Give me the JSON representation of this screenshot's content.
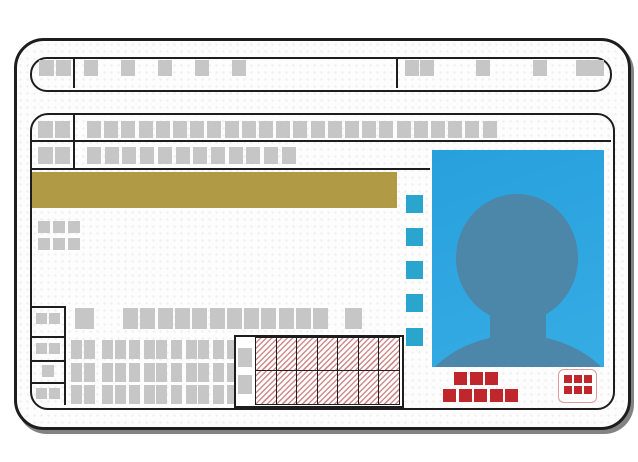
{
  "card": {
    "kind": "id-card-placeholder-illustration",
    "text_content": "none (all fields are placeholder blocks)"
  },
  "icons": {
    "photo_placeholder": "person-silhouette"
  },
  "colors": {
    "ink": "#1d1d1d",
    "placeholder_gray": "#c6c6c6",
    "gold_band": "#b09a46",
    "accent_blue": "#2aa5cd",
    "photo_background_top": "#27a0dc",
    "photo_background_bottom": "#36ace4",
    "silhouette_blue": "#4c86a8",
    "stamp_red": "#bf272c",
    "hatch_red": "#d08c8c",
    "stamp_box_border": "#e09b9b"
  },
  "blocks": {
    "header_left": [
      {
        "x": 39,
        "y": 60,
        "w": 15,
        "h": 16
      },
      {
        "x": 56,
        "y": 60,
        "w": 15,
        "h": 16
      }
    ],
    "header_mid": [
      {
        "x": 84,
        "y": 60,
        "w": 14,
        "h": 16,
        "repeat": 5,
        "pitch": 37
      }
    ],
    "header_right": [
      {
        "x": 405,
        "y": 60,
        "w": 14,
        "h": 16
      },
      {
        "x": 420,
        "y": 60,
        "w": 14,
        "h": 16
      },
      {
        "x": 476,
        "y": 60,
        "w": 14,
        "h": 16
      },
      {
        "x": 533,
        "y": 60,
        "w": 14,
        "h": 16
      },
      {
        "x": 576,
        "y": 60,
        "w": 14,
        "h": 16
      },
      {
        "x": 590,
        "y": 60,
        "w": 14,
        "h": 16
      }
    ],
    "band_row1_left": [
      {
        "x": 38,
        "y": 121,
        "w": 15,
        "h": 17
      },
      {
        "x": 55,
        "y": 121,
        "w": 15,
        "h": 17
      }
    ],
    "band_row1_run": [
      {
        "x": 87,
        "y": 121,
        "w": 14,
        "h": 17,
        "repeat": 24,
        "pitch": 17.2
      }
    ],
    "band_row2_left": [
      {
        "x": 38,
        "y": 147,
        "w": 15,
        "h": 17
      },
      {
        "x": 55,
        "y": 147,
        "w": 15,
        "h": 17
      }
    ],
    "band_row2_run": [
      {
        "x": 87,
        "y": 147,
        "w": 14,
        "h": 17,
        "repeat": 12,
        "pitch": 17.7
      }
    ],
    "mini_rows": [
      {
        "x": 38,
        "y": 221,
        "w": 12,
        "h": 12,
        "repeat": 3,
        "pitch": 15
      },
      {
        "x": 38,
        "y": 238,
        "w": 12,
        "h": 12,
        "repeat": 3,
        "pitch": 15
      }
    ],
    "number_label": [
      {
        "x": 36,
        "y": 313,
        "w": 11,
        "h": 11
      },
      {
        "x": 49,
        "y": 313,
        "w": 11,
        "h": 11
      }
    ],
    "number_big": [
      {
        "x": 75,
        "y": 308,
        "w": 19,
        "h": 21
      }
    ],
    "number_digits": [
      {
        "x": 123,
        "y": 308,
        "w": 15,
        "h": 21,
        "repeat": 12,
        "pitch": 17.3
      }
    ],
    "number_suffix": [
      {
        "x": 345,
        "y": 308,
        "w": 17,
        "h": 21
      }
    ],
    "left_cells": [
      {
        "x": 36,
        "y": 343,
        "w": 11,
        "h": 11
      },
      {
        "x": 49,
        "y": 343,
        "w": 11,
        "h": 11
      },
      {
        "x": 42,
        "y": 365,
        "w": 12,
        "h": 12
      },
      {
        "x": 36,
        "y": 388,
        "w": 11,
        "h": 11
      },
      {
        "x": 49,
        "y": 388,
        "w": 11,
        "h": 11
      }
    ],
    "kana_rows": [
      {
        "y": 340,
        "w": 11,
        "h": 19,
        "xs": [
          71,
          84,
          102,
          115,
          129,
          144,
          156,
          171,
          186,
          198,
          213,
          227
        ]
      },
      {
        "y": 363,
        "w": 11,
        "h": 19,
        "xs": [
          71,
          84,
          102,
          115,
          129,
          144,
          156,
          171,
          186,
          198,
          213,
          227
        ]
      },
      {
        "y": 385,
        "w": 11,
        "h": 19,
        "xs": [
          71,
          84,
          102,
          115,
          129,
          144,
          156,
          171,
          186,
          198,
          213,
          227
        ]
      }
    ],
    "table_labels": [
      {
        "x": 238,
        "y": 348,
        "w": 14,
        "h": 19
      },
      {
        "x": 238,
        "y": 375,
        "w": 14,
        "h": 19
      }
    ],
    "hatch_cells": [
      {
        "x": 255,
        "y": 337,
        "w": 20,
        "h": 33,
        "repeat": 7,
        "pitch": 20.5
      },
      {
        "x": 255,
        "y": 370,
        "w": 20,
        "h": 33,
        "repeat": 7,
        "pitch": 20.5
      }
    ],
    "blue_squares": [
      {
        "x": 406,
        "y": 195,
        "w": 17,
        "h": 18
      },
      {
        "x": 406,
        "y": 228,
        "w": 17,
        "h": 18
      },
      {
        "x": 406,
        "y": 261,
        "w": 17,
        "h": 18
      },
      {
        "x": 406,
        "y": 294,
        "w": 17,
        "h": 18
      },
      {
        "x": 406,
        "y": 328,
        "w": 17,
        "h": 18
      }
    ],
    "red_row_top": [
      {
        "x": 454,
        "y": 372,
        "w": 13,
        "h": 13,
        "repeat": 3,
        "pitch": 15.5
      }
    ],
    "red_row_bottom": [
      {
        "x": 443,
        "y": 389,
        "w": 13,
        "h": 13,
        "repeat": 5,
        "pitch": 15.6
      }
    ],
    "stamp_dots": [
      {
        "x": 5,
        "y": 5,
        "w": 8,
        "h": 8,
        "repeat": 3,
        "pitch": 10
      },
      {
        "x": 5,
        "y": 16,
        "w": 8,
        "h": 8,
        "repeat": 3,
        "pitch": 10
      }
    ]
  }
}
